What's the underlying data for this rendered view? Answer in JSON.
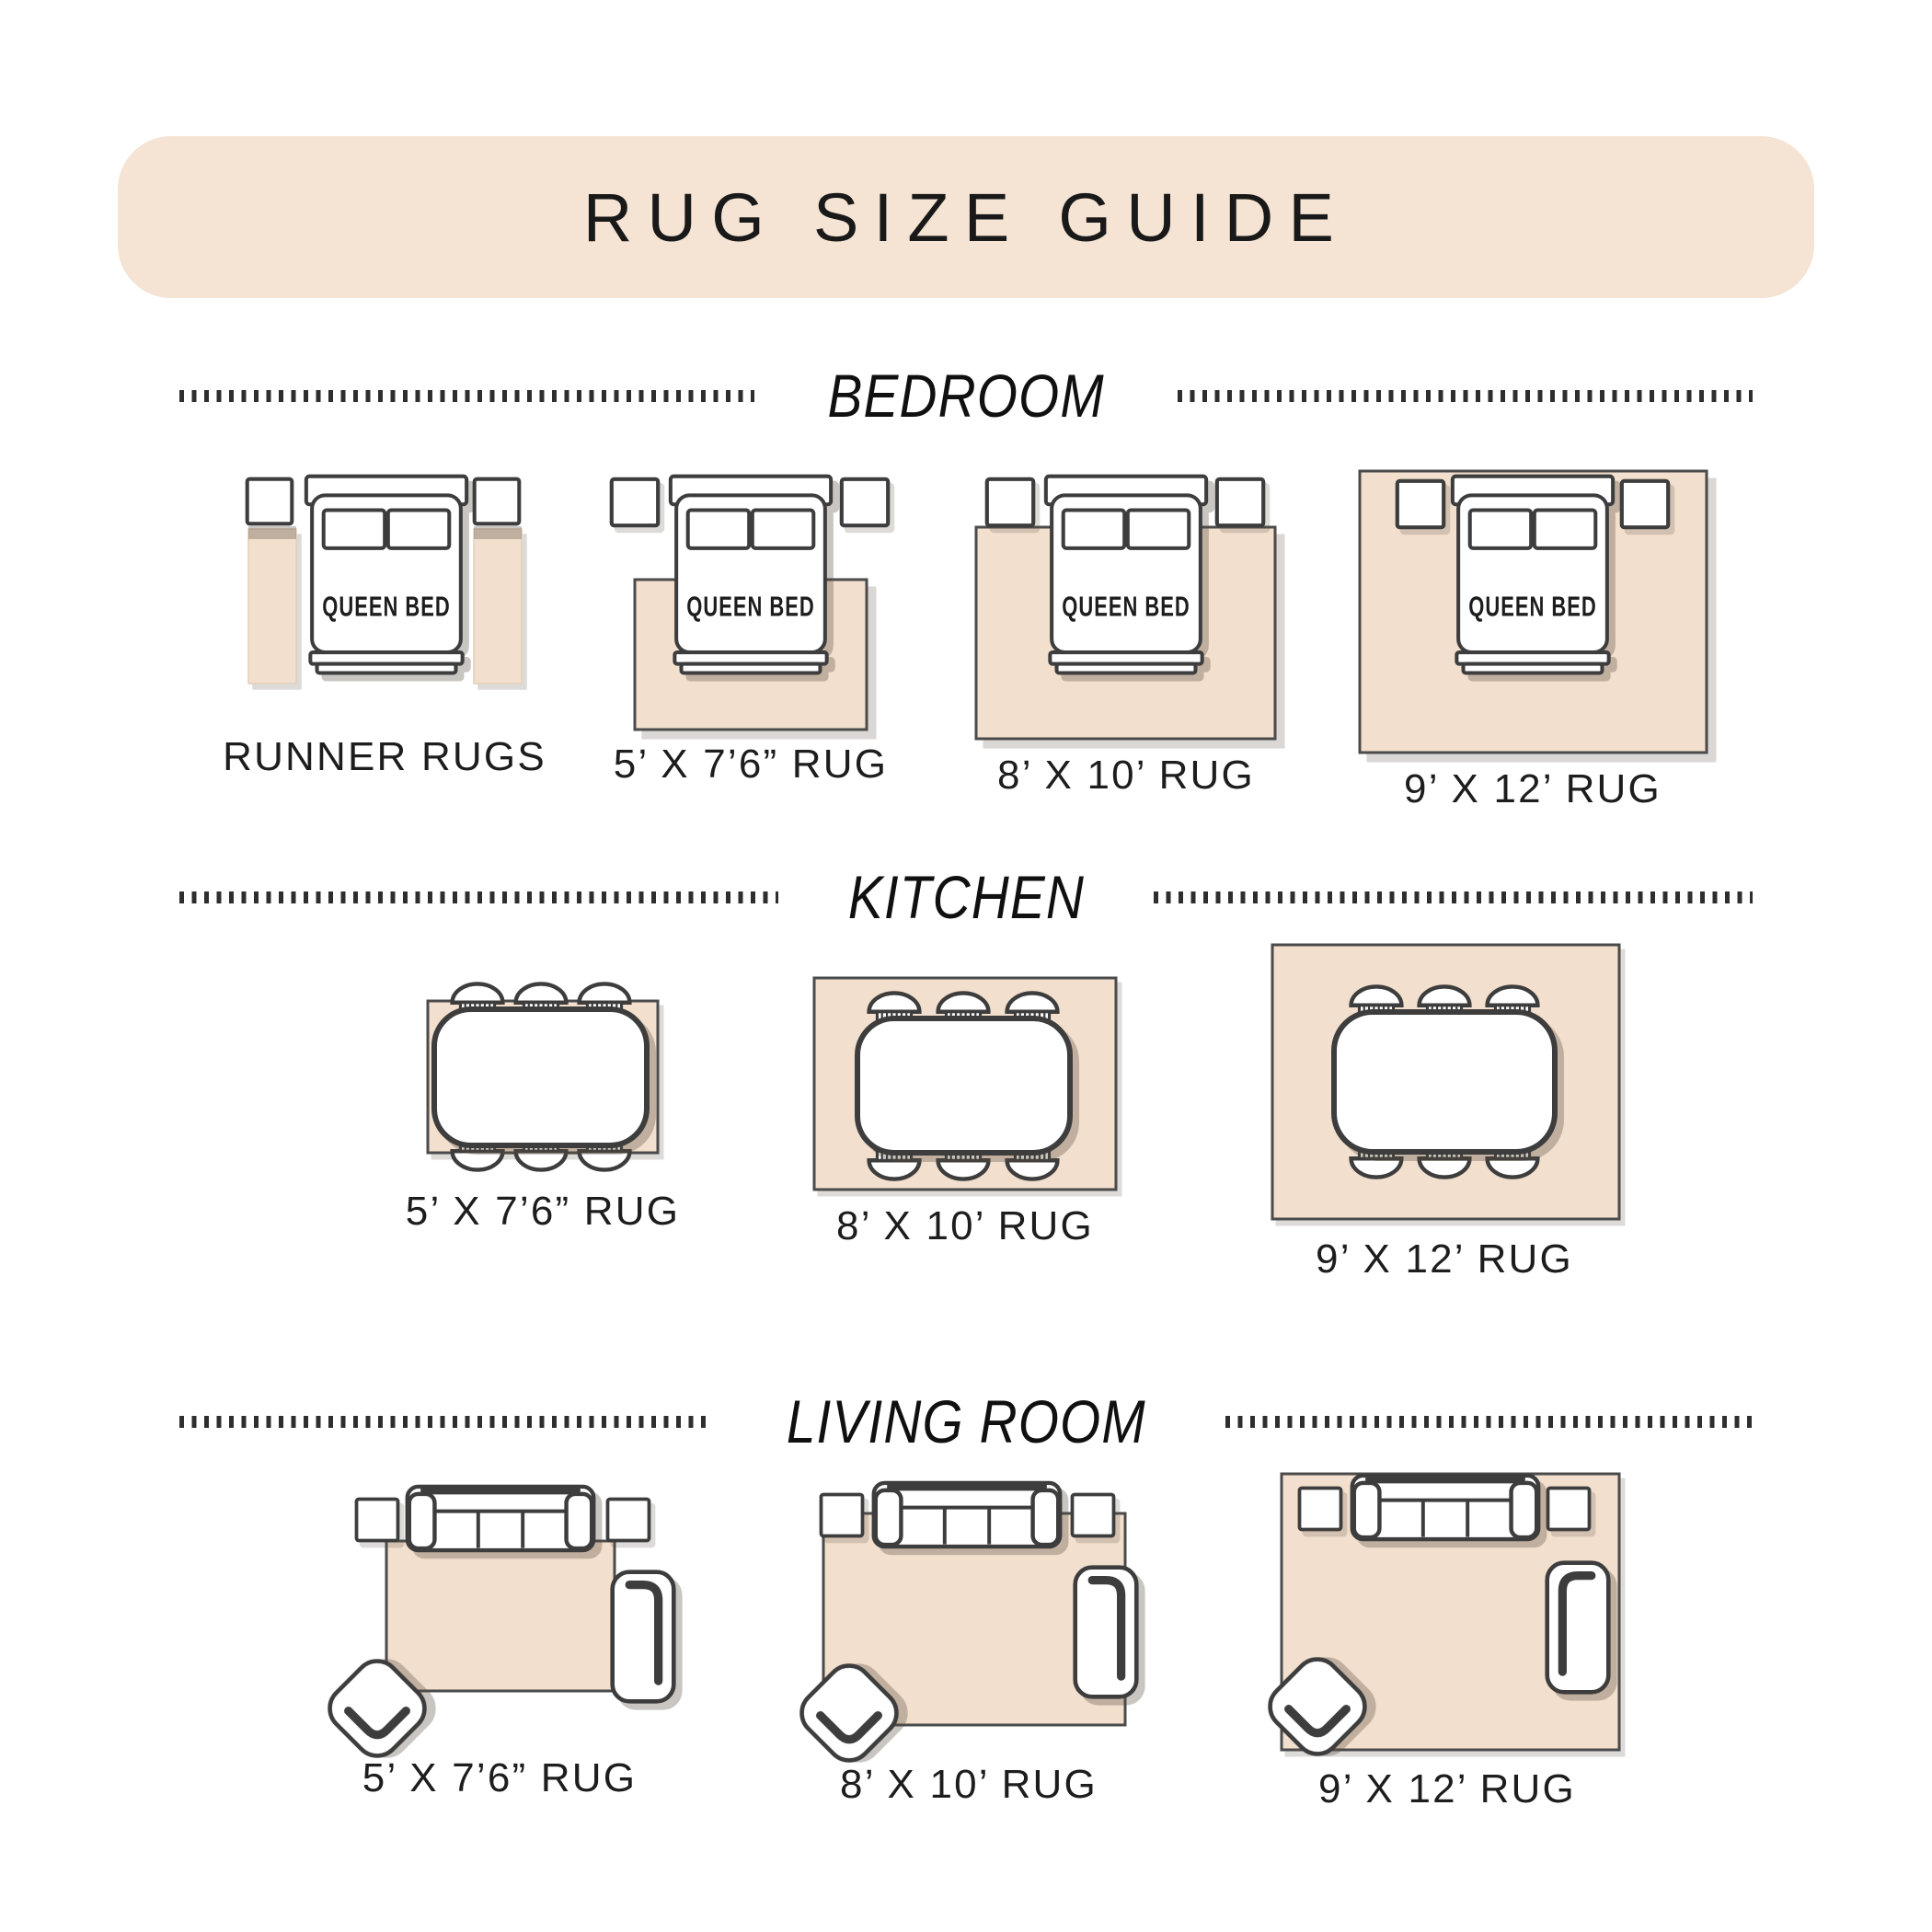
{
  "title": "RUG SIZE GUIDE",
  "bed_label": "QUEEN BED",
  "sections": [
    {
      "title": "BEDROOM",
      "items": [
        {
          "label": "RUNNER RUGS"
        },
        {
          "label": "5’ X 7’6” RUG"
        },
        {
          "label": "8’ X 10’ RUG"
        },
        {
          "label": "9’ X 12’ RUG"
        }
      ]
    },
    {
      "title": "KITCHEN",
      "items": [
        {
          "label": "5’ X 7’6” RUG"
        },
        {
          "label": "8’ X 10’ RUG"
        },
        {
          "label": "9’ X 12’ RUG"
        }
      ]
    },
    {
      "title": "LIVING ROOM",
      "items": [
        {
          "label": "5’ X 7’6” RUG"
        },
        {
          "label": "8’ X 10’ RUG"
        },
        {
          "label": "9’ X 12’ RUG"
        }
      ]
    }
  ],
  "icons": [
    "queen-bed",
    "nightstand",
    "runner-rug",
    "area-rug",
    "dining-table",
    "dining-chair",
    "sofa",
    "side-table",
    "accent-chair",
    "chaise"
  ],
  "colors": {
    "banner_beige": "#f5e3d3",
    "rug_beige": "#f2dfcd",
    "line_dark": "#3d3d3d",
    "rug_outline": "#4b4b4b",
    "text": "#1a1a1a"
  }
}
